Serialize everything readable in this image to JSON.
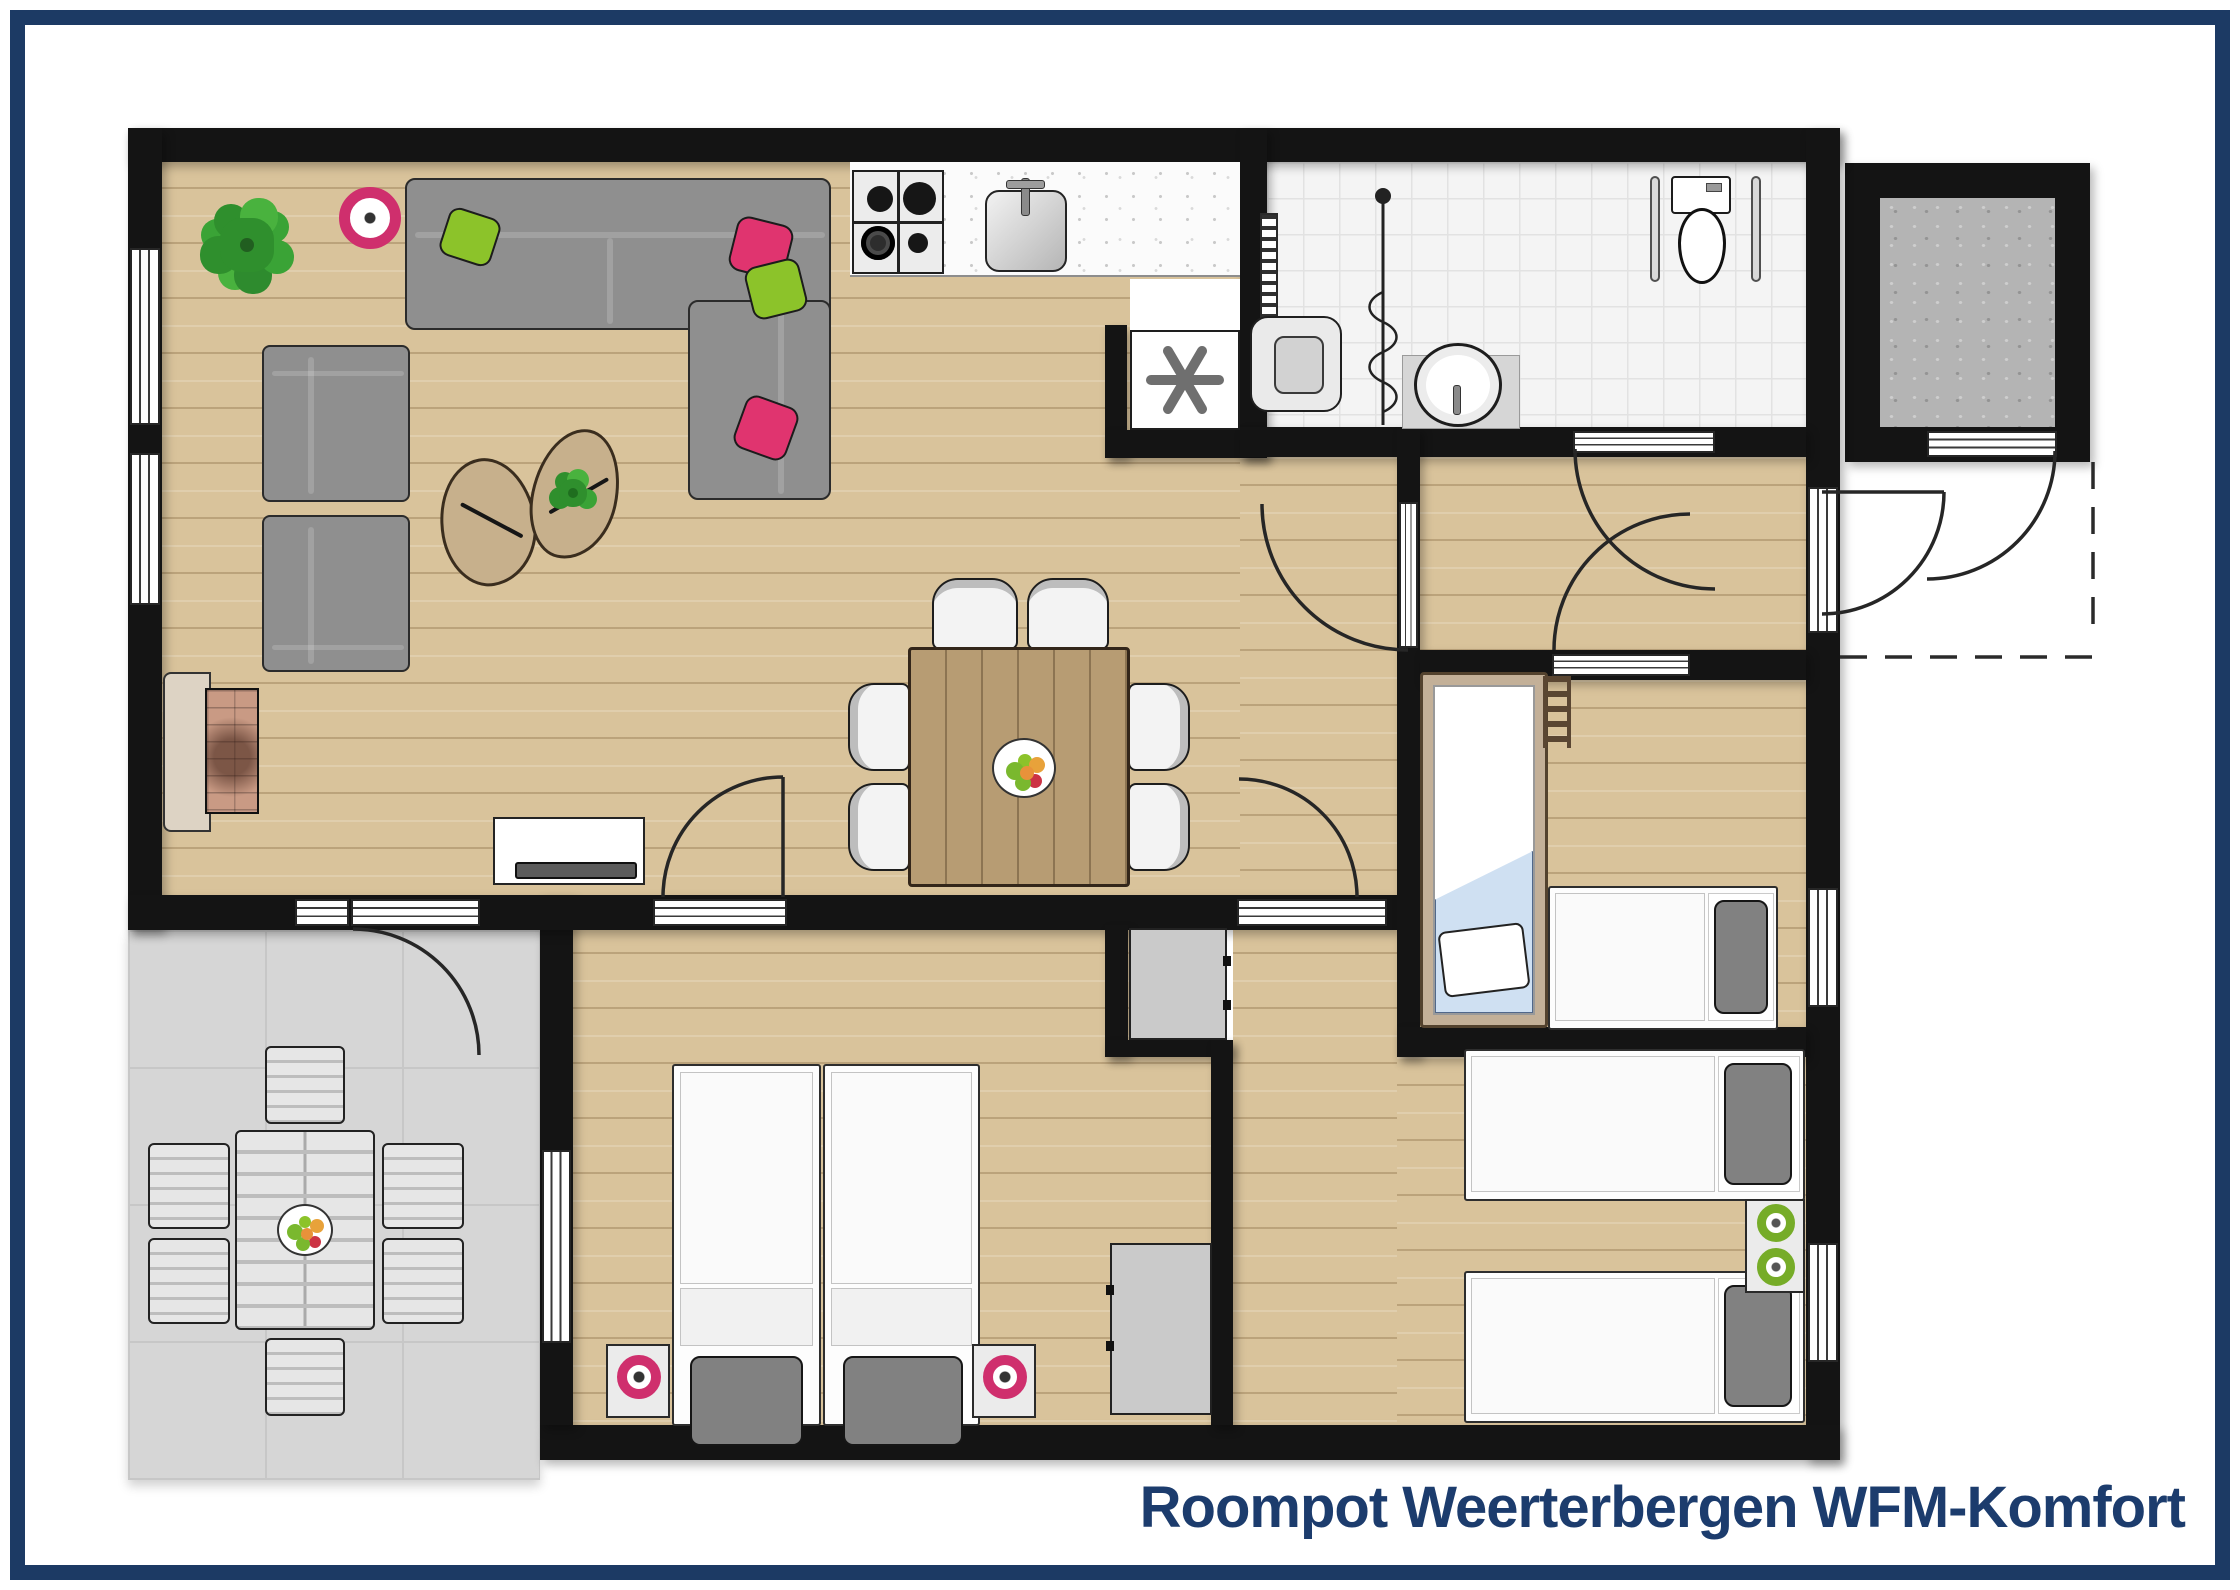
{
  "title": "Roompot Weerterbergen WFM-Komfort",
  "colors": {
    "frame_navy": "#1c3a64",
    "title_text": "#1c3c6d",
    "wall_black": "#141414",
    "wood_floor": "#d9c39b",
    "bathroom_tile": "#f4f4f4",
    "terrace_tile": "#d6d6d6",
    "storage_concrete": "#b4b4b4",
    "sofa_gray": "#8f8f8f",
    "accent_pink": "#e0346f",
    "accent_green": "#8cc32a",
    "lamp_pink": "#cf2f6d",
    "lamp_green": "#76ac28",
    "blanket_blue": "#cfe0f2",
    "table_wood": "#b79c73"
  },
  "plan": {
    "type": "holiday-home floor plan, top-down view, no room labels",
    "rooms": [
      "living-room",
      "kitchen",
      "bathroom-with-shower-and-toilet",
      "storage-room",
      "hallway",
      "double-bedroom",
      "bunk-bedroom",
      "twin-bedroom",
      "terrace",
      "entrance-porch"
    ],
    "furniture": {
      "living_room": [
        "corner-sofa with green and pink pillows",
        "two armchairs",
        "two pebble coffee tables",
        "plant",
        "pink floor lamp",
        "fireplace",
        "tv-sideboard"
      ],
      "kitchen": [
        "gas-hob 4 burners",
        "sink with faucet",
        "speckled counter",
        "appliance with asterisk symbol"
      ],
      "dining": [
        "square wooden table",
        "six white chairs",
        "fruit bowl"
      ],
      "bathroom": [
        "towel radiator",
        "fold-down shower seat",
        "shower rail with curtain",
        "oval wash basin",
        "toilet with two grab bars"
      ],
      "double_bedroom": [
        "double bed (two singles)",
        "two nightstands with pink lamps",
        "gray wardrobe",
        "niche cabinet"
      ],
      "bunk_bedroom": [
        "bunk bed with blue blanket and ladder",
        "single bed with gray pillow"
      ],
      "twin_bedroom": [
        "two single beds with gray pillows",
        "nightstand with two green lamps"
      ],
      "terrace": [
        "slatted outdoor table",
        "six outdoor chairs",
        "fruit bowl"
      ]
    }
  }
}
